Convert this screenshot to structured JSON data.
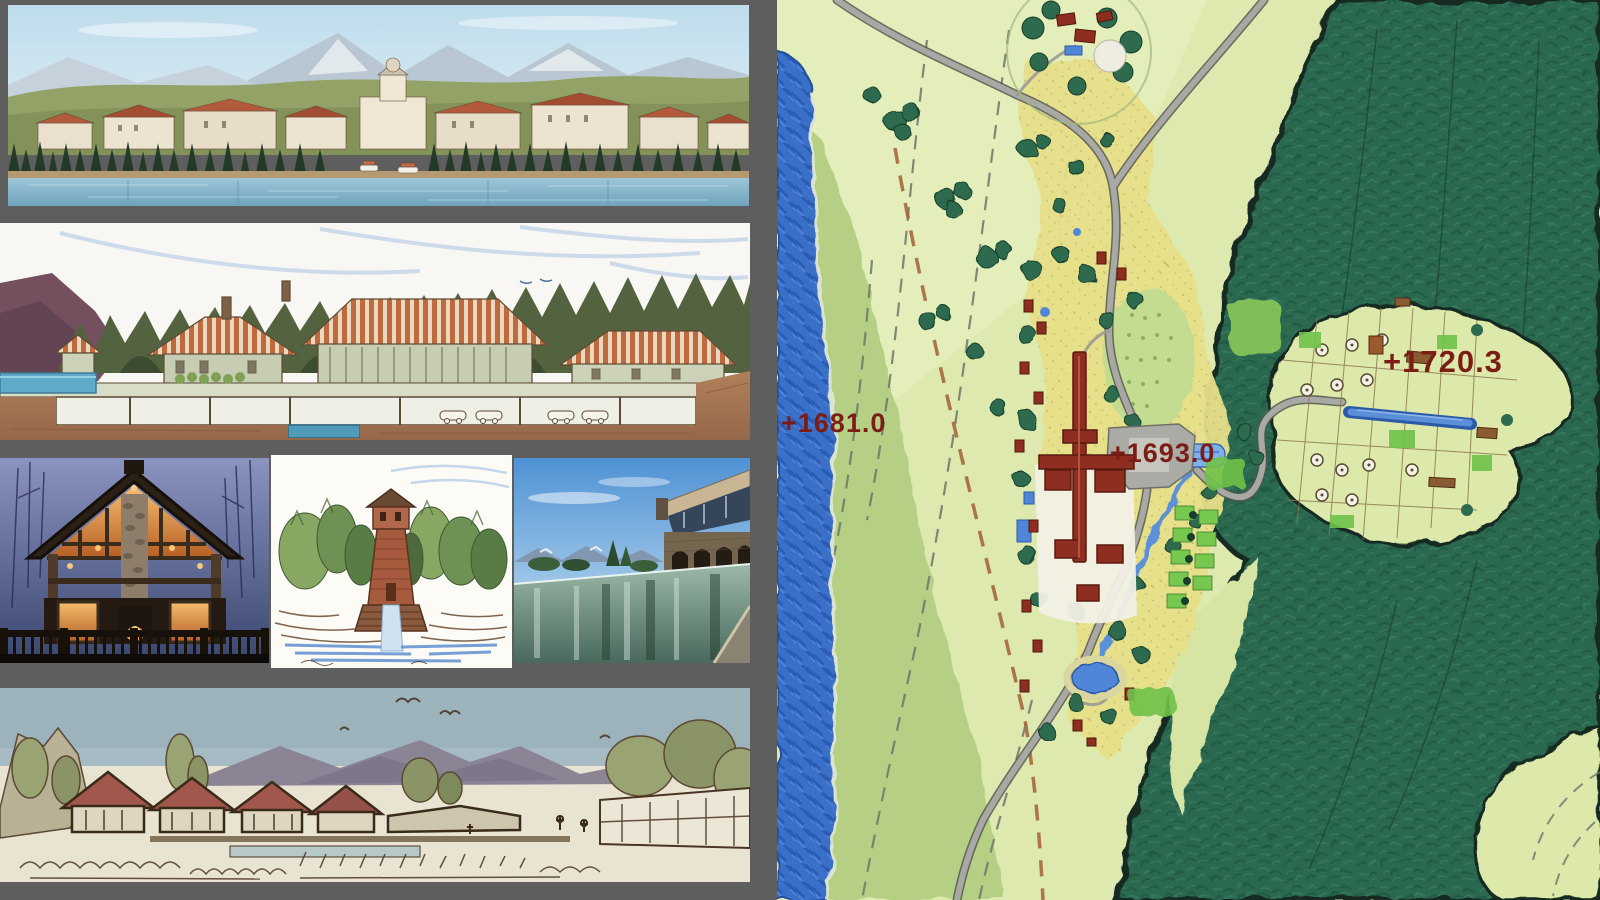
{
  "window": {
    "width": 1600,
    "height": 900,
    "background_gray": "#5e5e5e"
  },
  "left_column": {
    "panels": [
      {
        "id": "waterfront-panorama",
        "kind": "rendering",
        "description": "Lakefront resort village panorama with snowy mountains, forested hills and boats"
      },
      {
        "id": "section-elevation",
        "kind": "watercolor-section",
        "description": "Watercolor building elevation/section with striped roofs, underground parking and pools"
      },
      {
        "id": "lodge-photo",
        "kind": "photo",
        "description": "Timber lodge at dusk with glowing windows, stone chimney and deck"
      },
      {
        "id": "tower-sketch",
        "kind": "watercolor-sketch",
        "description": "Observation tower rising from forest above cascading water"
      },
      {
        "id": "pool-photo",
        "kind": "photo",
        "description": "Infinity lap pool beside a stone spa building"
      },
      {
        "id": "village-sketch",
        "kind": "ink-watercolor-sketch",
        "description": "Street-level village sketch with red roofs and mountains"
      }
    ]
  },
  "map": {
    "kind": "illustrative-master-plan",
    "elevation_labels": [
      {
        "text": "+1681.0"
      },
      {
        "text": "+1693.0"
      },
      {
        "text": "+1720.3"
      }
    ],
    "label_color": "#7b1d15",
    "colors": {
      "field_light": "#dde9ae",
      "meadow": "#b5d085",
      "lake": "#3a6fc8",
      "forest": "#2c6850",
      "village_ground": "#e7e08a",
      "road": "#a8a8a4",
      "building_red": "#8d2e21",
      "lawn_bright": "#6fc24a",
      "stream": "#5b90d8",
      "plaza_gray": "#ababa5"
    }
  }
}
